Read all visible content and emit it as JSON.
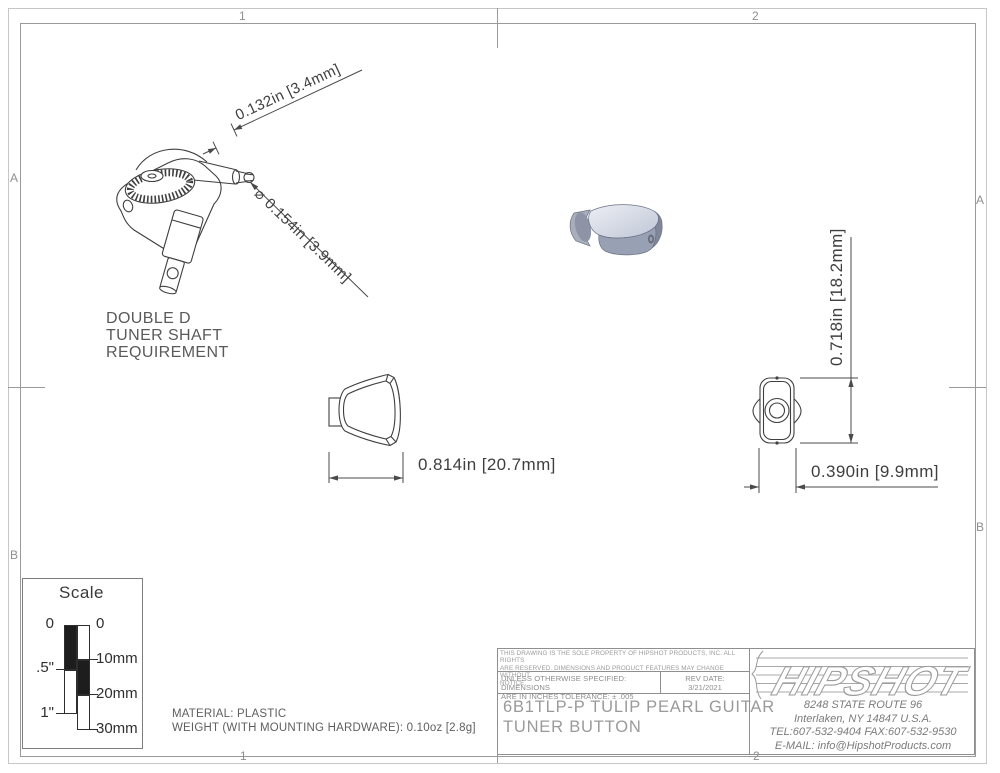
{
  "frame": {
    "zone_cols": [
      "1",
      "2"
    ],
    "zone_rows": [
      "A",
      "B"
    ]
  },
  "dims": {
    "tip_length": "0.132in [3.4mm]",
    "tip_diameter": "⌀ 0.154in [3.9mm]",
    "front_width": "0.814in [20.7mm]",
    "side_height": "0.718in [18.2mm]",
    "side_width": "0.390in [9.9mm]"
  },
  "note": {
    "lines": [
      "DOUBLE D",
      "TUNER SHAFT",
      "REQUIREMENT"
    ]
  },
  "scale_legend": {
    "title": "Scale",
    "inch_labels": [
      "0",
      ".5\"",
      "1\""
    ],
    "mm_labels": [
      "0",
      "10mm",
      "20mm",
      "30mm"
    ]
  },
  "material": {
    "line1": "MATERIAL: PLASTIC",
    "line2": "WEIGHT (WITH MOUNTING HARDWARE): 0.10oz [2.8g]"
  },
  "title_block": {
    "legal_lines": [
      "THIS DRAWING IS THE SOLE PROPERTY OF HIPSHOT PRODUCTS, INC. ALL RIGHTS",
      "ARE RESERVED. DIMENSIONS AND PRODUCT FEATURES MAY CHANGE WITHOUT",
      "NOTICE."
    ],
    "spec_lines": [
      "UNLESS OTHERWISE SPECIFIED: DIMENSIONS",
      "ARE IN INCHES TOLERANCE:  ± .005"
    ],
    "rev_label": "REV DATE:",
    "rev_value": "3/21/2021",
    "part_lines": [
      "6B1TLP-P TULIP PEARL GUITAR",
      "TUNER BUTTON"
    ],
    "brand": "HIPSHOT",
    "address_lines": [
      "8248 STATE ROUTE 96",
      "Interlaken, NY 14847 U.S.A.",
      "TEL:607-532-9404 FAX:607-532-9530",
      "E-MAIL: info@HipshotProducts.com"
    ]
  },
  "colors": {
    "drawing_line": "#3f3f3f",
    "frame_line": "#9a9a9a",
    "iso_top": "#d9dde8",
    "iso_front": "#98a0b3",
    "iso_side": "#7f8799"
  }
}
